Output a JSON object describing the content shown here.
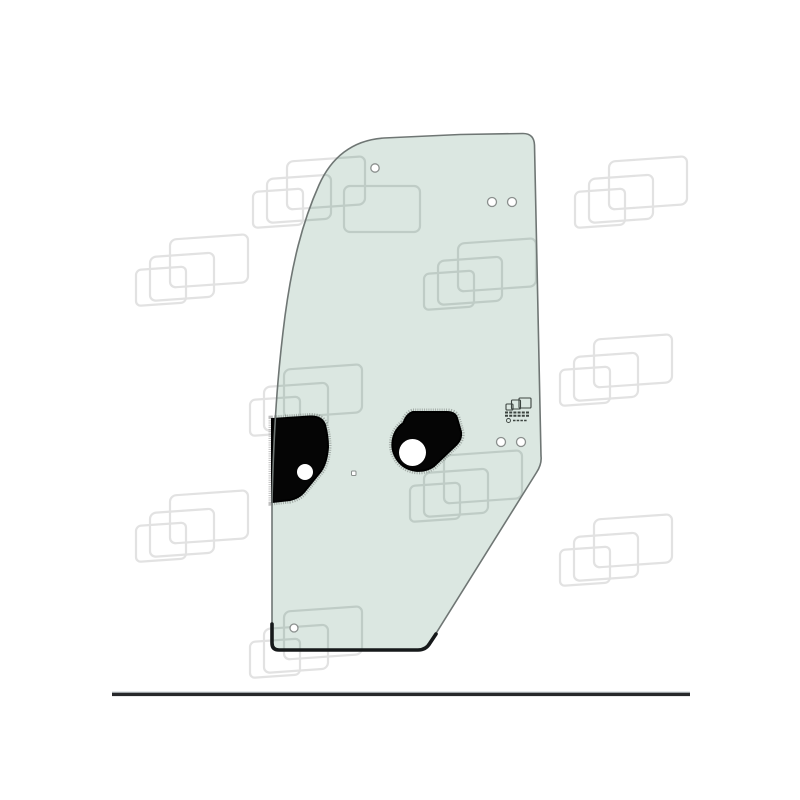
{
  "meta": {
    "description": "Watermarked catalog product photo of a left-hand cab door glass panel (tinted green glass) with mounting holes and black frit patches, above a horizontal footer rule"
  },
  "image": {
    "background": "#ffffff",
    "glass_fill": "#dbe7e1",
    "glass_outline": "#6f7674",
    "glass_bottom_edge": "#16191a",
    "patch_fill": "#050505",
    "watermark_stroke": "#e2e2e2",
    "watermark_stroke_on_glass": "#bfccc6",
    "hole_fill": "#ffffff",
    "hole_stroke": "#8a8f8d",
    "stamp_ink": "#3c4440"
  },
  "divider": {
    "fill": "#26282a",
    "highlight": "#c9d2d6"
  }
}
